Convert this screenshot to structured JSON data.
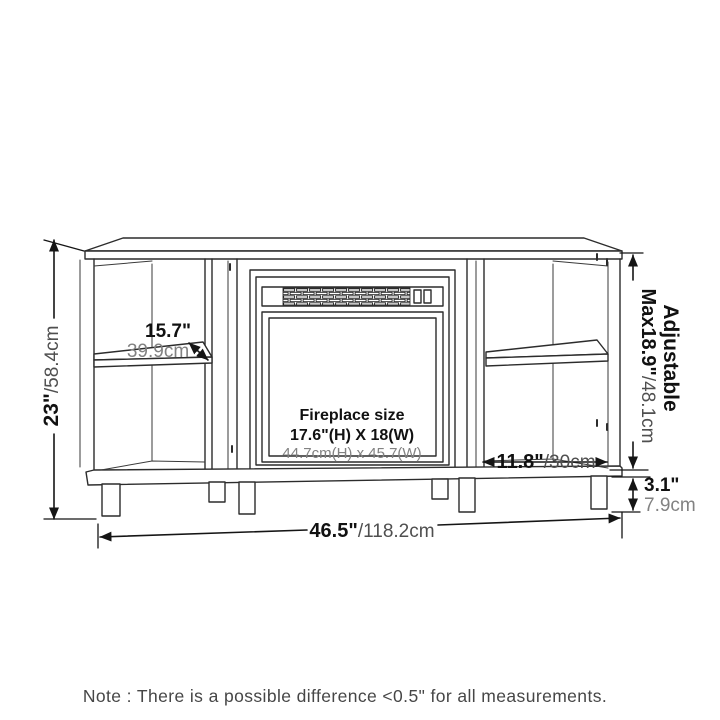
{
  "drawing": {
    "type": "furniture-dimension-diagram",
    "subject": "corner TV stand with electric fireplace opening",
    "colors": {
      "background": "#ffffff",
      "line": "#2c2c2c",
      "dimension_line": "#151515",
      "bold_text": "#111111",
      "cm_text": "#4f4f4f",
      "light_cm_text": "#828282"
    },
    "fireplace": {
      "title": "Fireplace size",
      "size_in": "17.6\"(H) X 18(W)",
      "size_cm": "44.7cm(H) x 45.7(W)"
    },
    "dims": {
      "height_in": "23\"",
      "height_cm": "/58.4cm",
      "shelf_depth_in": "15.7\"",
      "shelf_depth_cm": "39.9cm",
      "adjustable_label": "Adjustable",
      "adjustable_in": "Max18.9\"",
      "adjustable_cm": "/48.1cm",
      "open_shelf_in": "11.8\"",
      "open_shelf_cm": "/30cm",
      "leg_in": "3.1\"",
      "leg_cm": "7.9cm",
      "width_in": "46.5\"",
      "width_cm": "/118.2cm"
    },
    "note": "Note : There is a possible difference <0.5\" for all measurements."
  }
}
